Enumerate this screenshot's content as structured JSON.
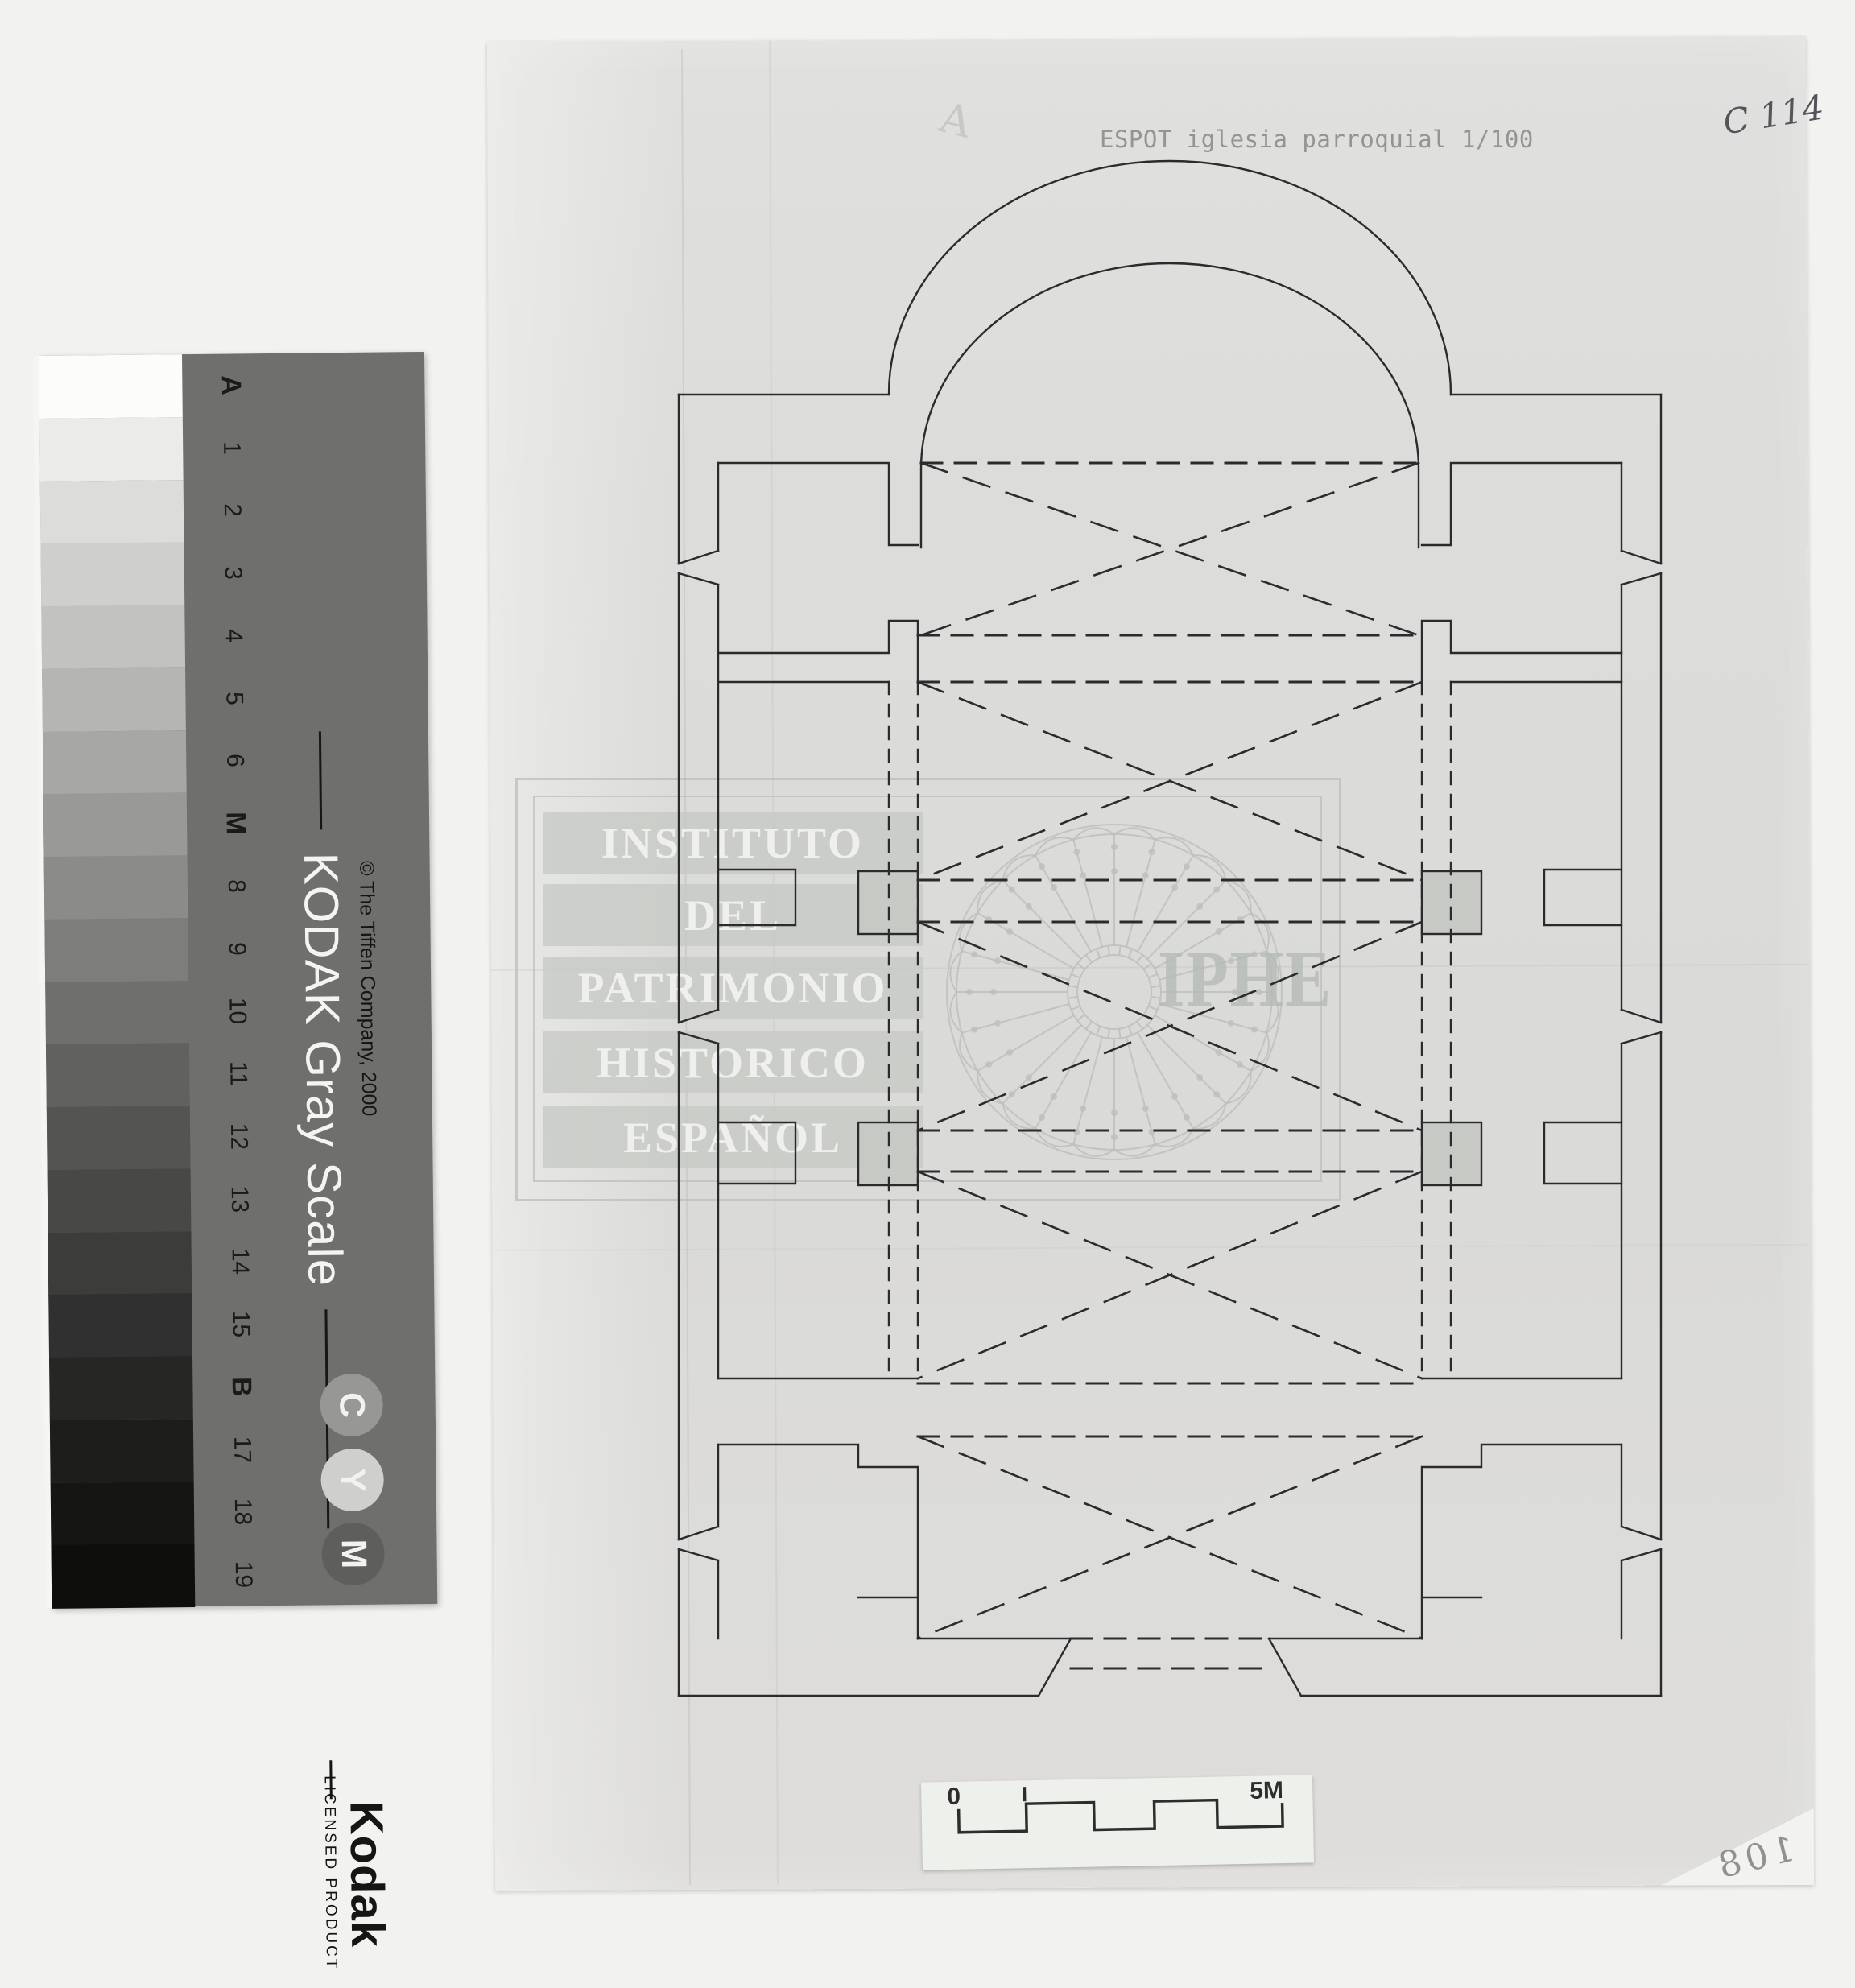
{
  "scan": {
    "title": "ESPOT iglesia parroquial 1/100",
    "catalog_code": "C 114",
    "page_number": "108",
    "faint_pencil_mark": "A"
  },
  "kodak_strip": {
    "product_title": "KODAK Gray Scale",
    "copyright": "© The Tiffen Company, 2000",
    "brand": "Kodak",
    "license_text": "LICENSED PRODUCT",
    "patch_labels": [
      "A",
      "1",
      "2",
      "3",
      "4",
      "5",
      "6",
      "M",
      "8",
      "9",
      "10",
      "11",
      "12",
      "13",
      "14",
      "15",
      "B",
      "17",
      "18",
      "19"
    ],
    "bold_labels": [
      "A",
      "M",
      "B"
    ],
    "patch_grays": [
      "#fcfcfa",
      "#ebebe9",
      "#dcdcda",
      "#cfcfcd",
      "#c2c2c0",
      "#b5b5b3",
      "#a7a7a5",
      "#999997",
      "#8b8b89",
      "#7d7d7b",
      "#6f6f6d",
      "#616160",
      "#545452",
      "#484846",
      "#3c3c3a",
      "#303030",
      "#262624",
      "#1d1d1b",
      "#151513",
      "#0e0e0c"
    ],
    "cym_letters": [
      "C",
      "Y",
      "M"
    ],
    "cym_circle_colors": [
      "#979795",
      "#cfcfcd",
      "#5e5e5c"
    ]
  },
  "watermark": {
    "lines": [
      "INSTITUTO",
      "DEL",
      "PATRIMONIO",
      "HISTORICO",
      "ESPAÑOL"
    ],
    "logo": "IPHE",
    "line_color": "#bcc0bb"
  },
  "scale_bar": {
    "zero_label": "0",
    "end_label": "5M",
    "segments": 5,
    "meters_per_segment": 1
  },
  "plan": {
    "ink_color": "#2b2b2e",
    "pier_fill": "#c7c9c5",
    "drawing_scale": "1/100"
  }
}
